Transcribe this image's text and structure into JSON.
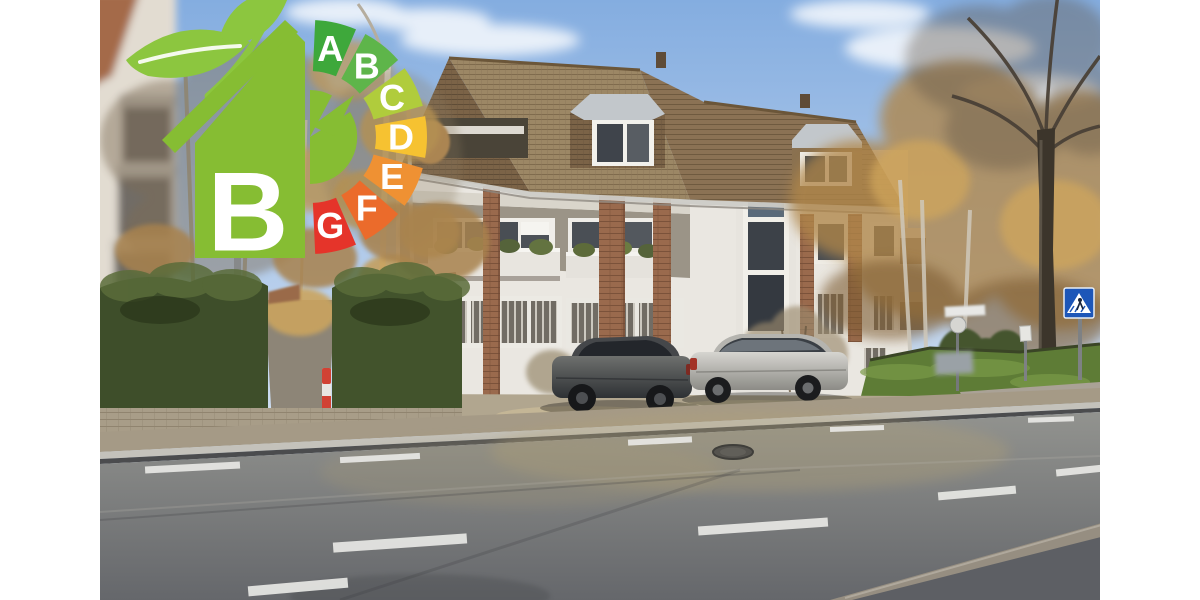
{
  "window": {
    "width": 1200,
    "height": 600,
    "background": "#ffffff"
  },
  "photo": {
    "kind": "street-view-of-apartment-building",
    "width": 1000,
    "height": 600
  },
  "energy_badge": {
    "rating": "B",
    "house_color": "#86bd33",
    "leaf_color": "#8cc63f",
    "disc_color": "#86bd33",
    "letter_color": "#ffffff",
    "classes": [
      {
        "label": "A",
        "color": "#3ea83b"
      },
      {
        "label": "B",
        "color": "#5eb54a"
      },
      {
        "label": "C",
        "color": "#b0cc3c"
      },
      {
        "label": "D",
        "color": "#f6c231"
      },
      {
        "label": "E",
        "color": "#ef9133"
      },
      {
        "label": "F",
        "color": "#eb6b2b"
      },
      {
        "label": "G",
        "color": "#e5342a"
      }
    ]
  },
  "scene": {
    "sky": {
      "top": "#84ade0",
      "bottom": "#d8e4f3"
    },
    "roof_color": "#8d7352",
    "facade_color": "#eae7e1",
    "brick_color": "#9a6a4d",
    "hedge_color": "#42532c",
    "grass_color": "#5e7c36",
    "road_color": "#7f8084",
    "autumn_foliage_color": "#b0864e",
    "signs": [
      {
        "type": "pedestrian-crossing",
        "color": "#1d56b8"
      }
    ],
    "vehicles": [
      {
        "type": "sedan",
        "color": "#4a4c4c"
      },
      {
        "type": "sedan",
        "color": "#b5b4af"
      }
    ],
    "road_markings": "dashed-white-lane-lines",
    "bollard_colors": [
      "#e8e6e2",
      "#d14234"
    ]
  }
}
